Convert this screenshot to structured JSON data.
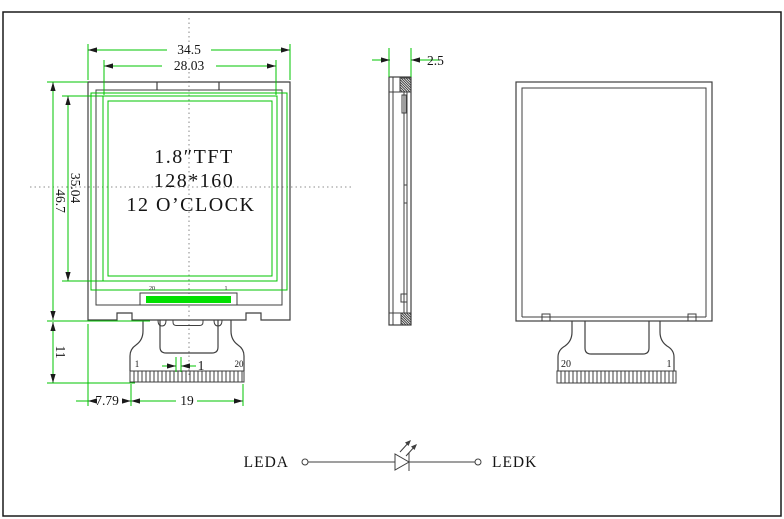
{
  "meta": {
    "drawing_type": "TFT LCD module outline drawing",
    "colors": {
      "background": "#ffffff",
      "outline": "#3f3f3f",
      "dimension": "#00c400",
      "highlight": "#00e000",
      "text": "#141414"
    }
  },
  "front_view": {
    "display_label_line1": "1.8″TFT",
    "display_label_line2": "128*160",
    "display_label_line3": "12 O’CLOCK",
    "dim_outer_width": "34.5",
    "dim_active_width": "28.03",
    "dim_outer_height": "46.7",
    "dim_active_height": "35.04",
    "dim_fpc_length": "11",
    "dim_pin_offset": "7.79",
    "dim_pin_span": "19",
    "dim_pin_pitch": "1",
    "fpc_pin_first": "1",
    "fpc_pin_last": "20",
    "seal_pin_left": "20",
    "seal_pin_right": "1"
  },
  "side_view": {
    "dim_thickness": "2.5"
  },
  "back_view": {
    "fpc_pin_left": "20",
    "fpc_pin_right": "1"
  },
  "led_circuit": {
    "anode_label": "LEDA",
    "cathode_label": "LEDK"
  }
}
